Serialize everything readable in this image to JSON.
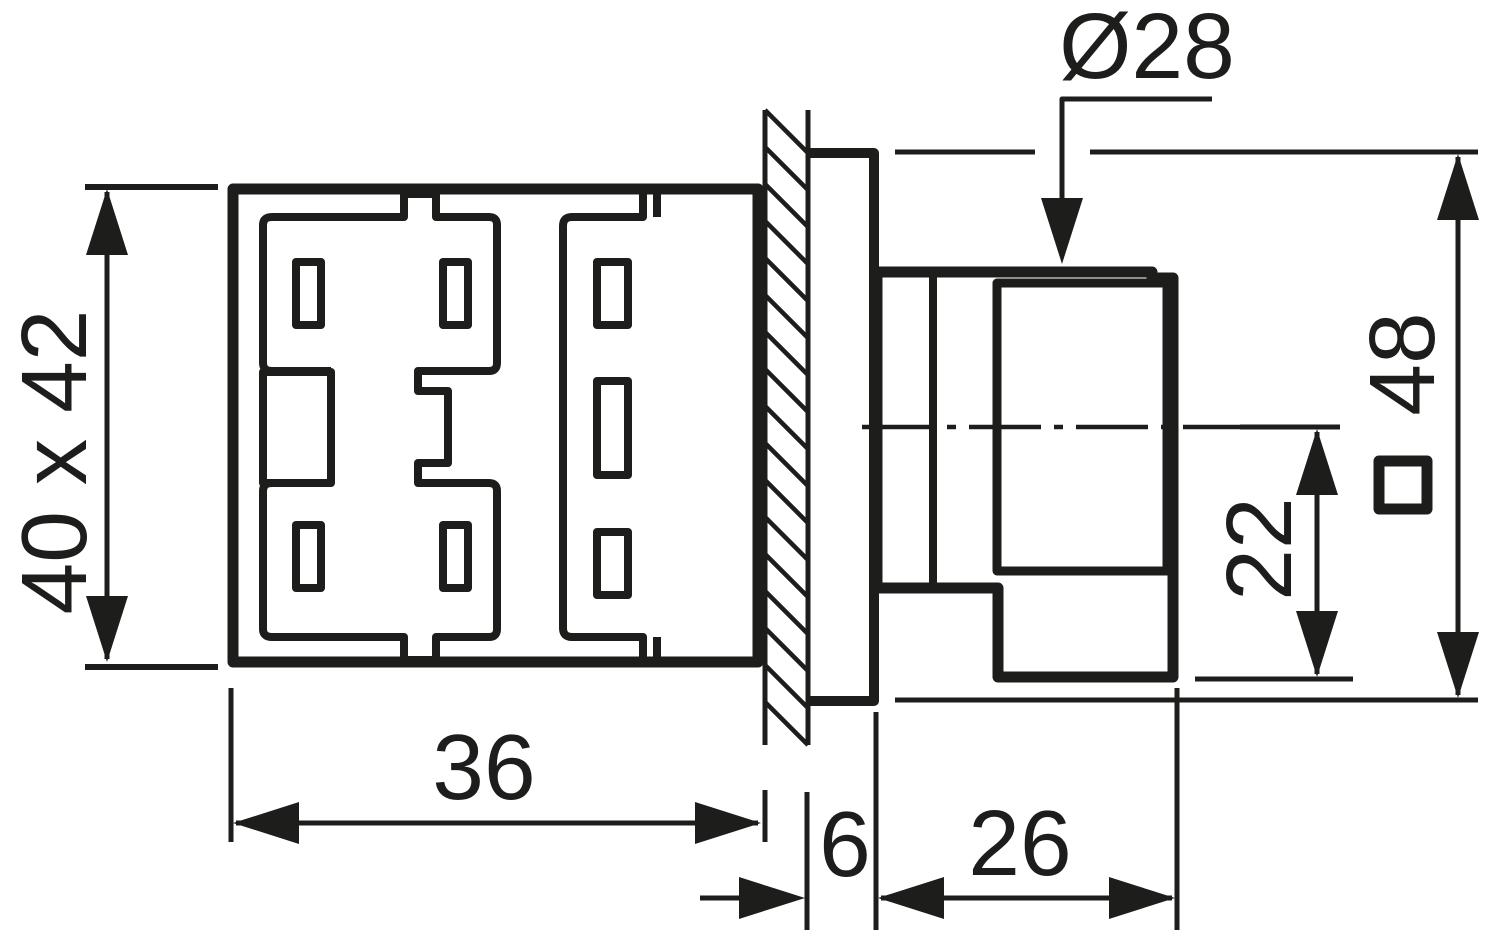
{
  "drawing": {
    "type": "technical-dimension-drawing",
    "subject": "panel-mounted control unit side and rear view",
    "colors": {
      "ink": "#1d1d1b",
      "paper": "#ffffff"
    },
    "labels": {
      "rear_body_cross_section": "40 x 42",
      "rear_body_depth": "36",
      "bezel_thickness": "6",
      "front_head_depth": "26",
      "button_offset": "22",
      "actuator_hole_diameter": "Ø28",
      "bezel_square_size": "48",
      "square_section_symbol": "□"
    }
  }
}
